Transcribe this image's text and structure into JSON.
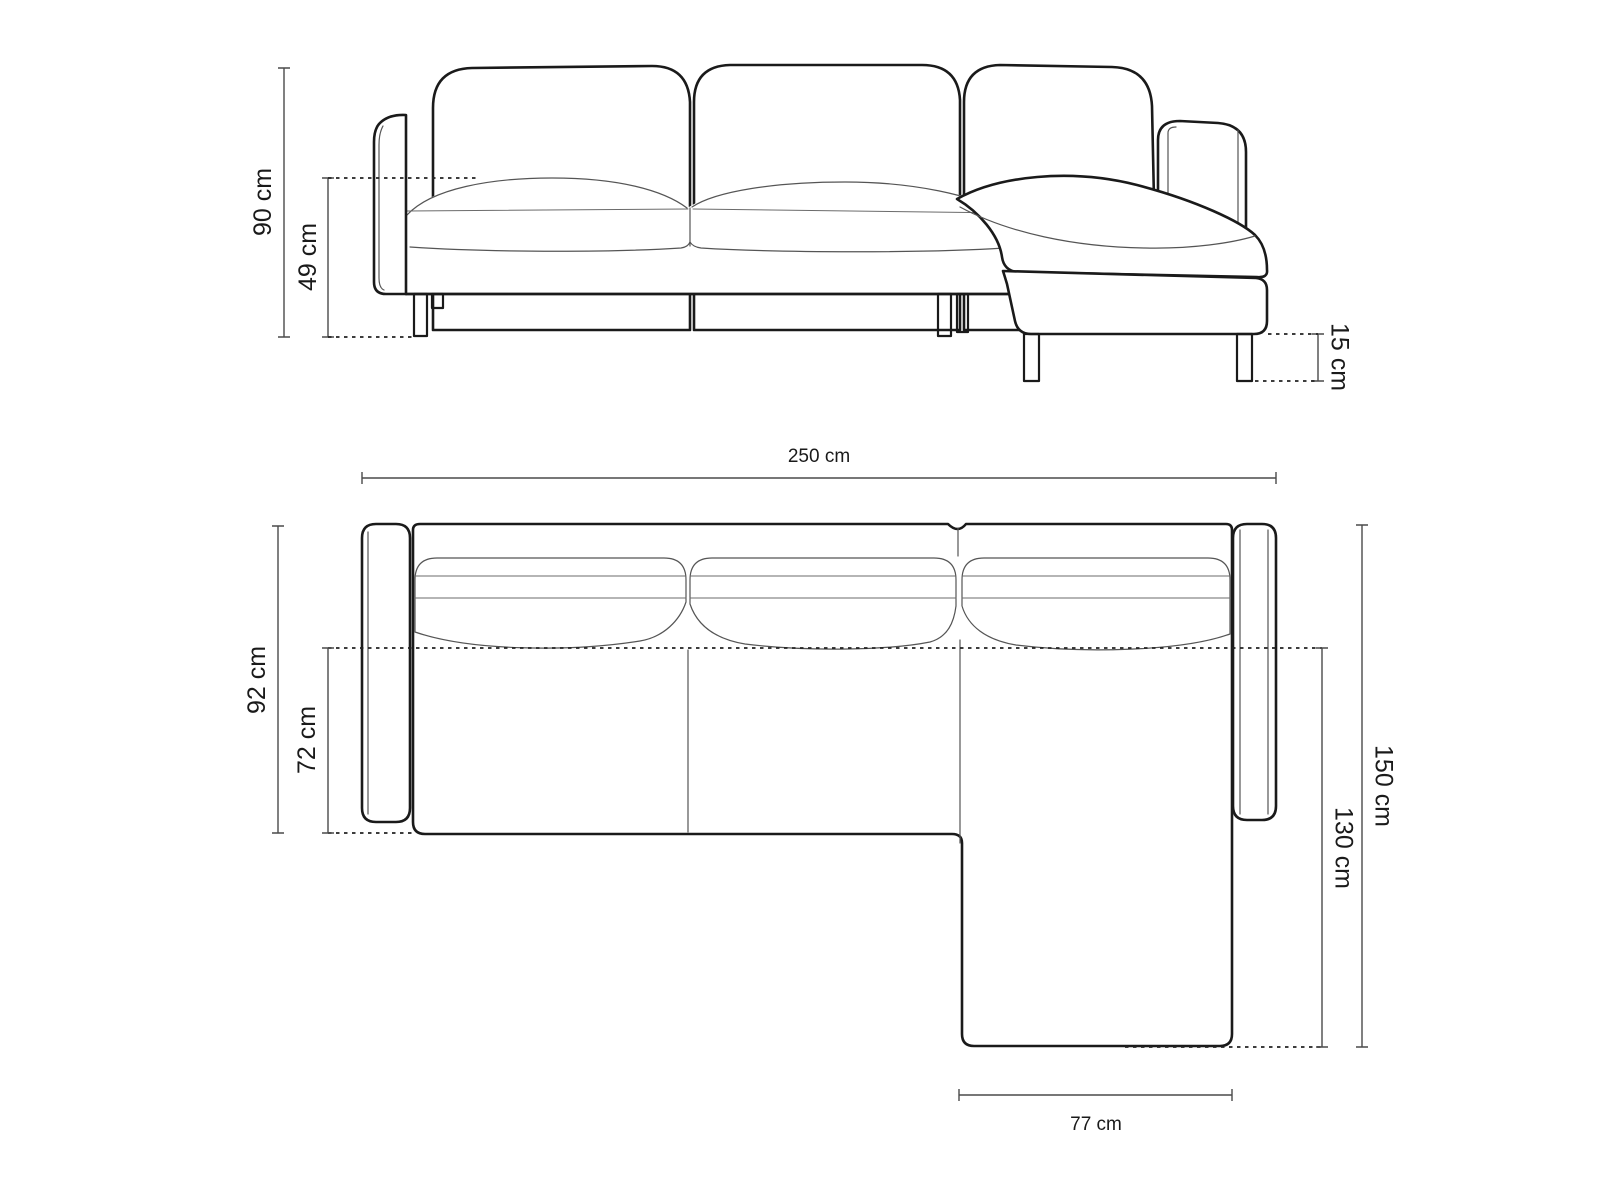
{
  "colors": {
    "background": "#ffffff",
    "outline": "#1a1a1a",
    "seam_line": "#555555",
    "dimension_line": "#4a4a4a",
    "label_text": "#1a1a1a"
  },
  "front_view": {
    "dim_total_height": "90 cm",
    "dim_seat_height": "49 cm",
    "dim_leg_height": "15 cm"
  },
  "top_view": {
    "dim_total_width": "250 cm",
    "dim_body_depth": "92 cm",
    "dim_seat_depth": "72 cm",
    "dim_total_depth": "150 cm",
    "dim_chaise_depth": "130 cm",
    "dim_chaise_width": "77 cm"
  }
}
